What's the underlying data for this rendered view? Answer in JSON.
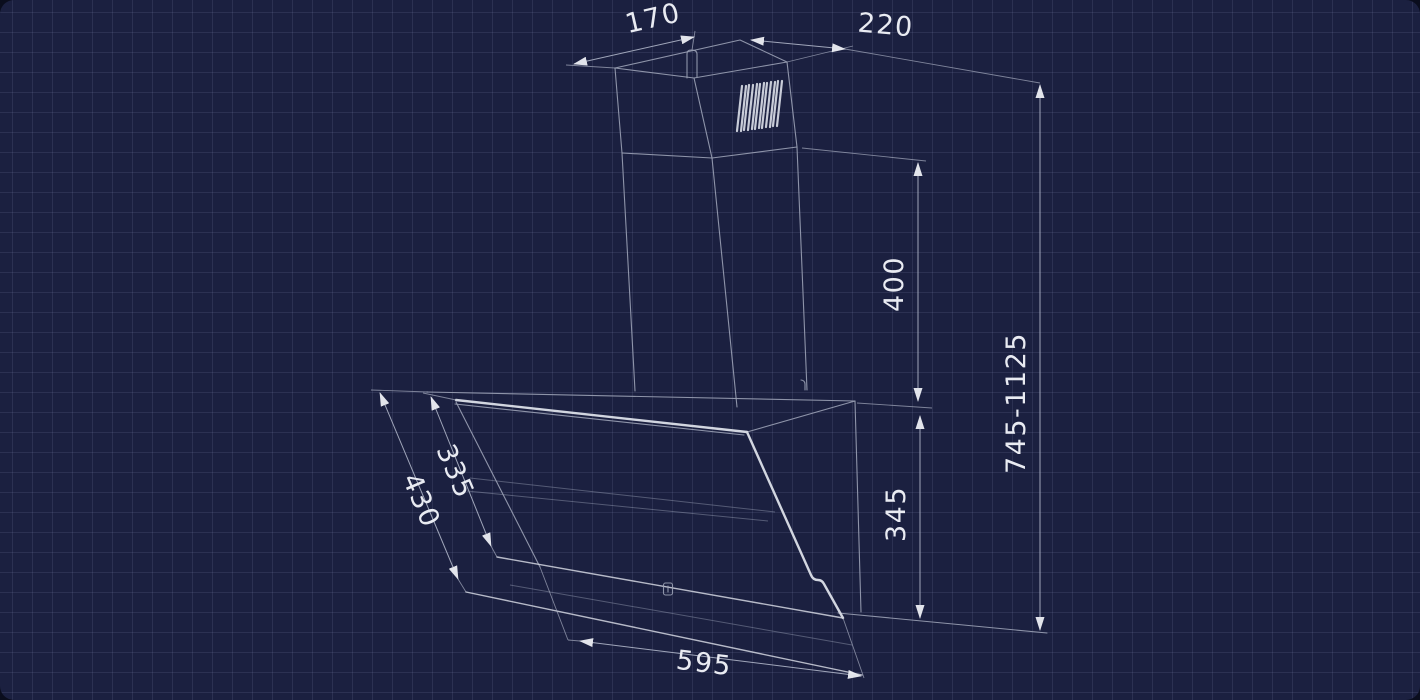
{
  "meta": {
    "figure_type": "technical-dimension-diagram",
    "subject": "Wall-mounted angled cooker hood with telescopic chimney"
  },
  "theme": {
    "page_bg": "#0a0d1d",
    "canvas_bg": "#1b2040",
    "grid_line": "rgba(151,163,205,0.13)",
    "line": "#9ba1b5",
    "line_bright": "#d2d6e0",
    "dim_line": "#a8aec1",
    "arrow": "#edeff5",
    "text": "#e9ebf2"
  },
  "dimensions": {
    "chimney_top_width": {
      "label": "170"
    },
    "chimney_top_depth": {
      "label": "220"
    },
    "chimney_height": {
      "label": "400"
    },
    "overall_height_range": {
      "label": "745-1125"
    },
    "body_back_height": {
      "label": "345"
    },
    "glass_upper_length": {
      "label": "335"
    },
    "glass_total_length": {
      "label": "430"
    },
    "body_width": {
      "label": "595"
    }
  }
}
